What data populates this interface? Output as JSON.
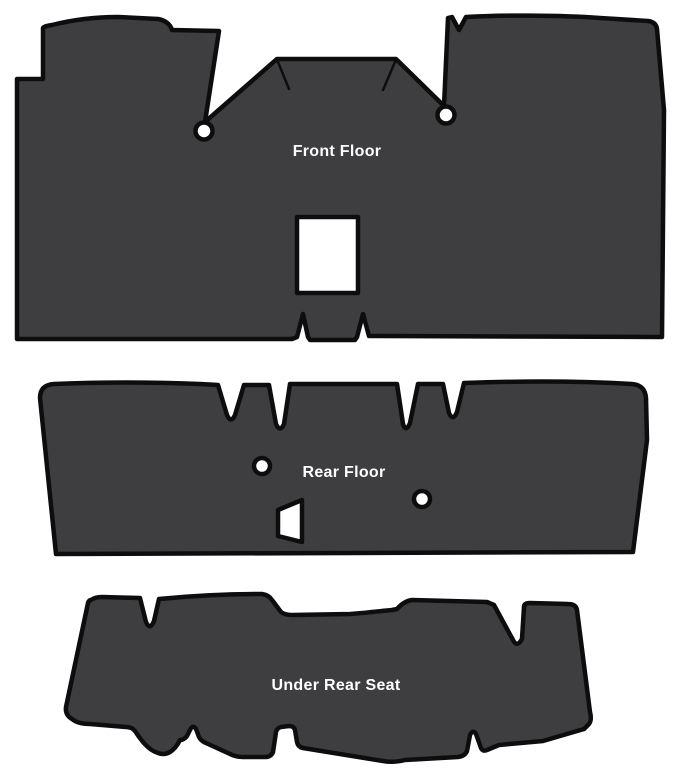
{
  "page": {
    "background": "#ffffff"
  },
  "diagram": {
    "fill_color": "#3e3e40",
    "outline_color": "#0d0d0d",
    "label_color": "#ffffff",
    "pieces": [
      {
        "id": "front-floor",
        "label": "Front Floor",
        "label_pos": {
          "x": 337,
          "y": 156
        },
        "outline": "M17 79 L43 79 L43 28 Q44 26 52 25 C72 20 96 17 118 17 L158 19 Q169 21 172 30 L219 31 L205 122 L277 59 L396 59 L444 106 L448 18 L452 17 L459 30 L466 17 C500 15 560 15 600 18 L648 21 Q656 22 657 29 L664 110 L662 337 L369 336 L363 314 L357 337 L355 340 L310 340 L308 337 L303 314 L297 337 L292 339 L17 339 Z",
        "cutouts": {
          "shifter_hole": "M297 217 L358 217 L358 293 L297 293 Z",
          "grommet_left": {
            "cx": 204,
            "cy": 131,
            "r": 8.5
          },
          "grommet_right": {
            "cx": 446,
            "cy": 115,
            "r": 8.5
          }
        },
        "score_lines": {
          "left": "M278 62 L289 89",
          "right": "M395 62 L383 90"
        }
      },
      {
        "id": "rear-floor",
        "label": "Rear Floor",
        "label_pos": {
          "x": 344,
          "y": 477
        },
        "outline": "M40 398 Q40 385 54 384 C100 382 150 382 200 384 L218 385 L227 415 Q231 424 235 415 L244 385 L269 385 L276 424 Q280 433 284 424 L290 384 L397 384 L403 424 Q406 433 410 423 L418 384 L443 384 L449 413 Q453 422 457 412 L464 383 C520 381 580 381 632 384 Q645 385 646 398 L647 440 L633 552 L56 554 Z",
        "cutouts": {
          "grommet_left": {
            "cx": 262,
            "cy": 466,
            "r": 8
          },
          "grommet_right": {
            "cx": 422,
            "cy": 499,
            "r": 8
          },
          "wedge_hole": "M278 510 L302 500 L302 542 L278 536 Z"
        }
      },
      {
        "id": "under-rear-seat",
        "label": "Under Rear Seat",
        "label_pos": {
          "x": 336,
          "y": 690
        },
        "outline": "M91 600 Q95 597 102 597 L140 598 L146 622 Q150 631 154 621 L159 599 C190 596 230 594 262 594 Q269 595 272 600 L281 612 Q285 615 292 615 L350 614 C365 613 380 611 392 610 L397 609 Q404 601 412 600 L487 602 L494 605 L513 640 Q517 648 522 639 L524 607 Q524 603 530 603 L568 604 Q576 604 577 610 L590 712 Q592 720 589 724 L584 729 L543 741 L499 745 L487 750 Q483 752 481 748 L476 734 Q473 729 470 735 L467 751 Q465 756 458 757 L405 760 Q393 763 383 761 L303 748 Q298 747 297 742 L295 730 Q294 726 289 726 L281 727 Q277 728 276 732 L273 752 Q271 757 265 757 L243 757 Q236 757 230 754 L206 743 Q201 741 199 737 L196 729 Q193 724 190 730 L187 736 Q184 740 180 740 C174 752 166 756 158 753 C148 750 141 740 135 731 Q132 727 126 727 L90 724 Q78 724 72 719 Q65 715 66 707 L88 603 Q89 600 91 600 Z"
      }
    ]
  }
}
